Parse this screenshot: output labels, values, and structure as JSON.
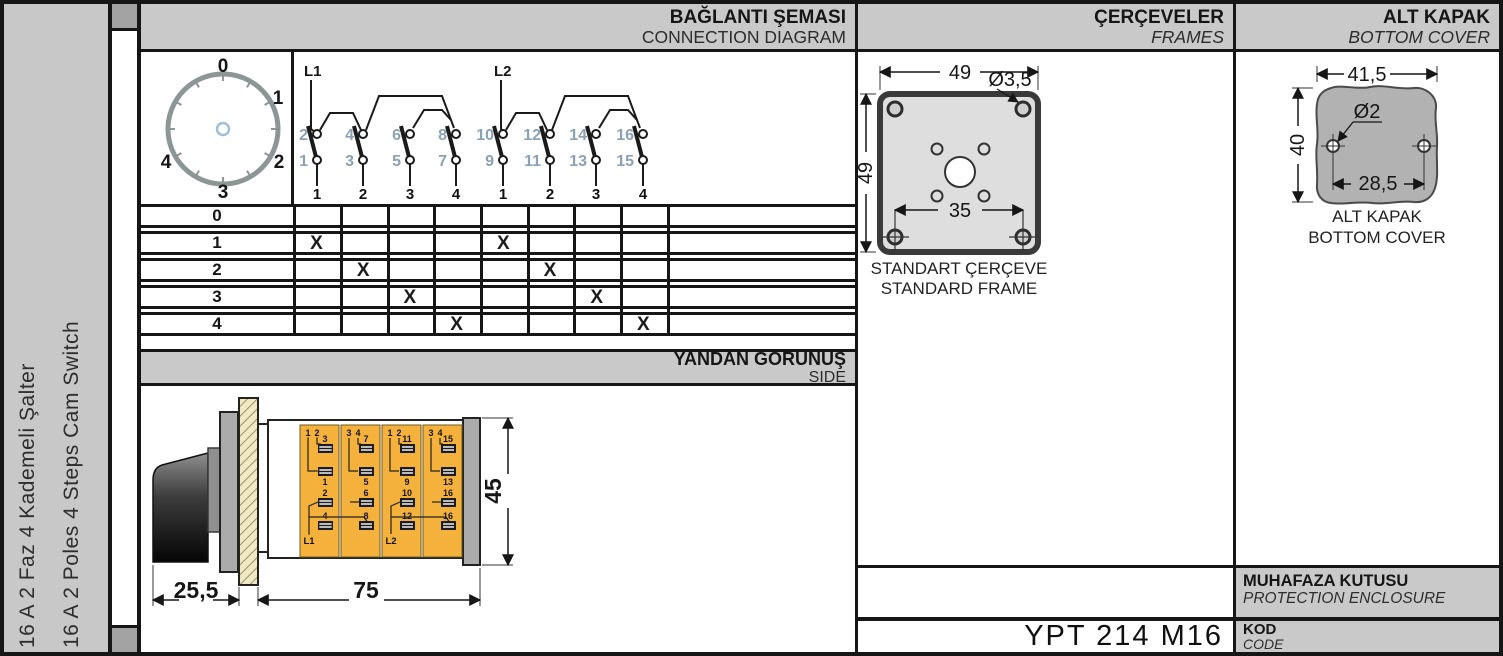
{
  "sidebar": {
    "title_tr": "16 A 2 Faz 4 Kademeli Şalter",
    "title_en": "16 A 2 Poles 4 Steps Cam Switch"
  },
  "headers": {
    "connection": {
      "tr": "BAĞLANTI ŞEMASI",
      "en": "CONNECTION DIAGRAM"
    },
    "frames": {
      "tr": "ÇERÇEVELER",
      "en": "FRAMES"
    },
    "bottom_cover": {
      "tr": "ALT KAPAK",
      "en": "BOTTOM COVER"
    },
    "side_view": {
      "tr": "YANDAN GÖRÜNÜŞ",
      "en": "SIDE"
    }
  },
  "dial": {
    "positions": [
      "0",
      "1",
      "2",
      "3",
      "4"
    ]
  },
  "contacts": {
    "l1": "L1",
    "l2": "L2",
    "top_terminals": [
      "2",
      "4",
      "6",
      "8",
      "10",
      "12",
      "14",
      "16"
    ],
    "bottom_terminals": [
      "1",
      "3",
      "5",
      "7",
      "9",
      "11",
      "13",
      "15"
    ],
    "group_numbers": [
      "1",
      "2",
      "3",
      "4",
      "1",
      "2",
      "3",
      "4"
    ]
  },
  "switch_table": {
    "row_labels": [
      "0",
      "1",
      "2",
      "3",
      "4"
    ],
    "marks": [
      [],
      [
        1,
        5
      ],
      [
        2,
        6
      ],
      [
        3,
        7
      ],
      [
        4,
        8
      ]
    ],
    "mark_char": "X"
  },
  "side_view_drawing": {
    "dims": {
      "knob_depth": "25,5",
      "body_length": "75",
      "body_height": "45"
    },
    "stages": [
      {
        "pin_a": "1",
        "pin_b": "2",
        "upper": "3",
        "mid": "1",
        "in_a": "2",
        "in_b": "4",
        "feed": "L1"
      },
      {
        "pin_a": "3",
        "pin_b": "4",
        "upper": "7",
        "mid": "5",
        "in_a": "6",
        "in_b": "8",
        "feed": ""
      },
      {
        "pin_a": "1",
        "pin_b": "2",
        "upper": "11",
        "mid": "9",
        "in_a": "10",
        "in_b": "12",
        "feed": "L2"
      },
      {
        "pin_a": "3",
        "pin_b": "4",
        "upper": "15",
        "mid": "13",
        "in_a": "16",
        "in_b": "16",
        "feed": ""
      }
    ]
  },
  "frame_drawing": {
    "dims": {
      "width": "49",
      "height": "49",
      "hole": "Ø3,5",
      "hole_spacing": "35"
    },
    "caption_tr": "STANDART ÇERÇEVE",
    "caption_en": "STANDARD FRAME"
  },
  "cover_drawing": {
    "dims": {
      "width": "41,5",
      "height": "40",
      "hole": "Ø2",
      "hole_spacing": "28,5"
    },
    "caption_tr": "ALT KAPAK",
    "caption_en": "BOTTOM COVER"
  },
  "footer": {
    "enclosure_tr": "MUHAFAZA KUTUSU",
    "enclosure_en": "PROTECTION ENCLOSURE",
    "code_label_tr": "KOD",
    "code_label_en": "CODE",
    "code_value": "YPT 214 M16"
  },
  "colors": {
    "band_gray": "#c9c9c9",
    "line_black": "#161616",
    "terminal_blue": "#8ba1b4",
    "stage_yellow": "#f4b13c",
    "hatch_cream": "#f0e9c5",
    "plate_gray": "#acacac",
    "frame_fill": "#dedede",
    "cover_fill": "#b2b2b2"
  }
}
